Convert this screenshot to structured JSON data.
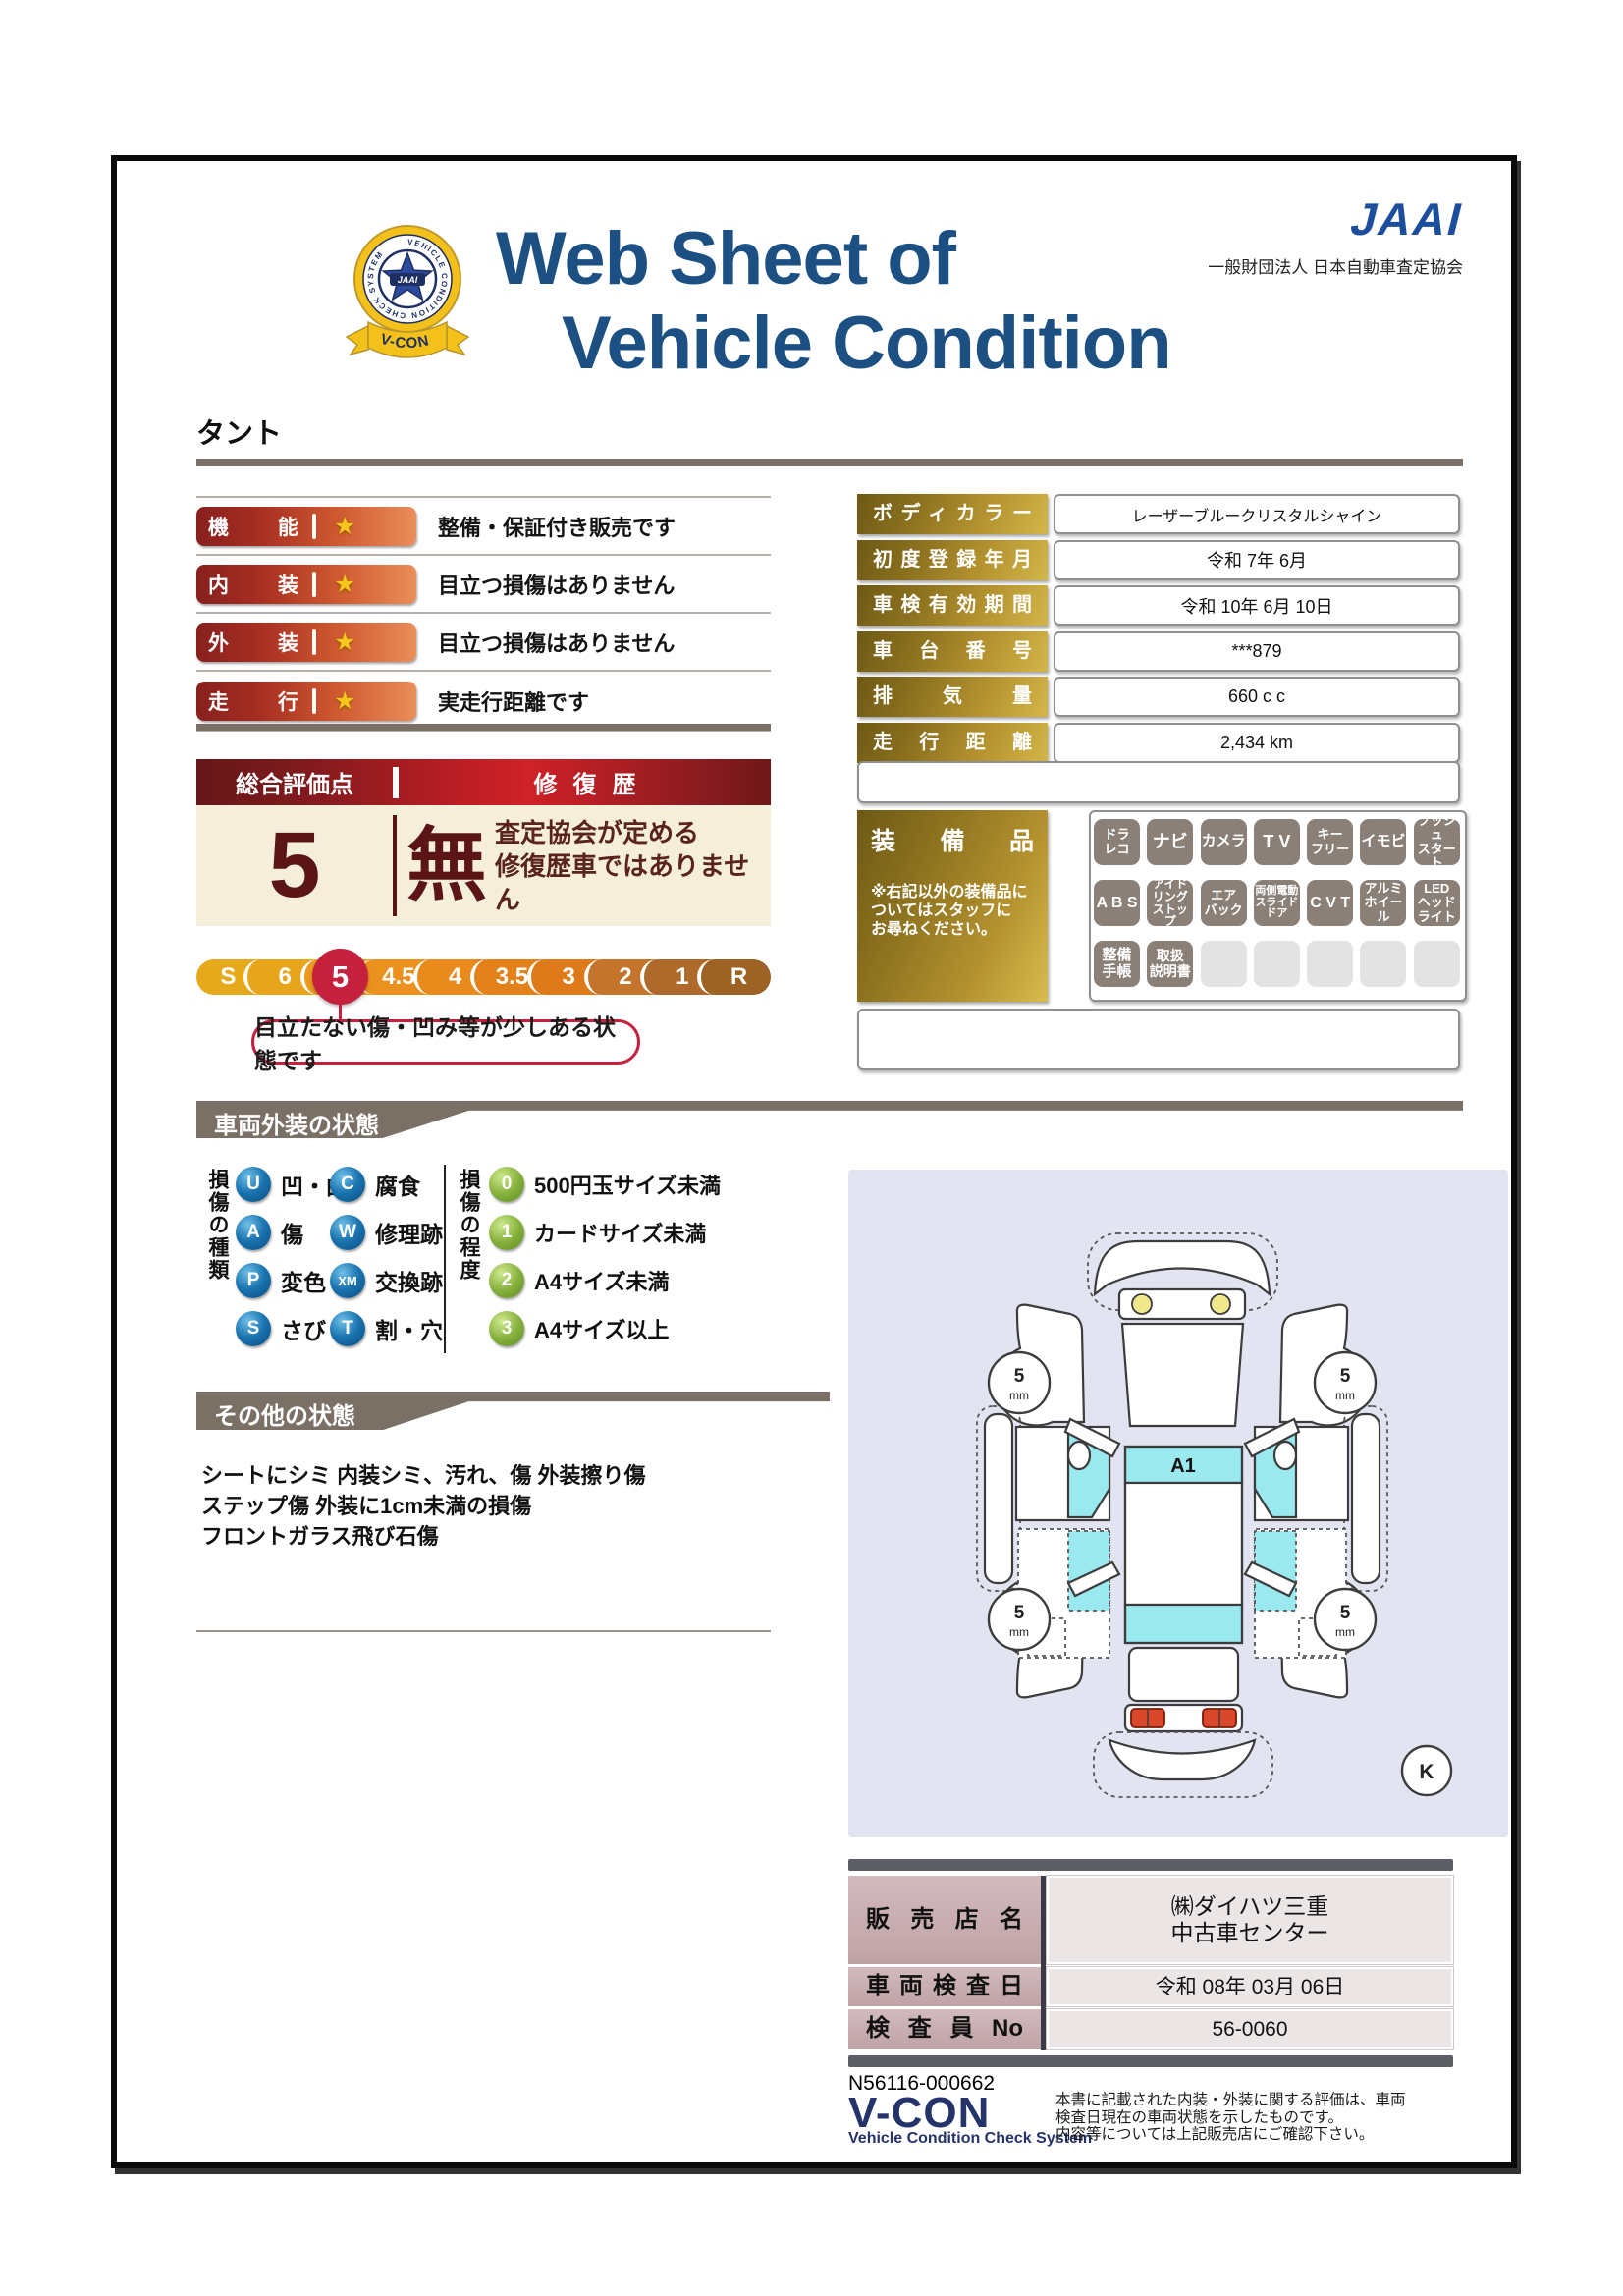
{
  "colors": {
    "accent_red": "#c6203f",
    "maroon": "#5c1517",
    "gold": "#b4922f",
    "navy_title": "#1c5083",
    "jaai_blue": "#1b4f9e",
    "banner_gray": "#7b7065",
    "equip_badge": "#8b8078",
    "legend_blue": "#1a74b0",
    "legend_green": "#86b13c",
    "diagram_bg": "#e2e4f1",
    "diagram_cyan": "#9ae9ee"
  },
  "header": {
    "title_line1": "Web Sheet of",
    "title_line2": "Vehicle Condition",
    "badge": {
      "center": "JAAI",
      "ring": "VEHICLE CONDITION CHECK SYSTEM",
      "ribbon": "V-CON"
    },
    "jaai_wordmark": "JAAI",
    "jaai_org": "一般財団法人 日本自動車査定協会"
  },
  "vehicle_name": "タント",
  "ratings": [
    {
      "label": "機能",
      "star": "★",
      "description": "整備・保証付き販売です"
    },
    {
      "label": "内装",
      "star": "★",
      "description": "目立つ損傷はありません"
    },
    {
      "label": "外装",
      "star": "★",
      "description": "目立つ損傷はありません"
    },
    {
      "label": "走行",
      "star": "★",
      "description": "実走行距離です"
    }
  ],
  "details": [
    {
      "label": "ボディカラー",
      "value": "レーザーブルークリスタルシャイン"
    },
    {
      "label": "初度登録年月",
      "value": "令和 7年 6月"
    },
    {
      "label": "車検有効期間",
      "value": "令和 10年 6月 10日"
    },
    {
      "label": "車台番号",
      "value": "***879"
    },
    {
      "label": "排気量",
      "value": "660 c c"
    },
    {
      "label": "走行距離",
      "value": "2,434 km"
    }
  ],
  "evaluation": {
    "score_title": "総合評価点",
    "repair_title": "修復歴",
    "score": "5",
    "repair_value": "無",
    "repair_note1": "査定協会が定める",
    "repair_note2": "修復歴車ではありません",
    "scale": [
      "S",
      "6",
      "5",
      "4.5",
      "4",
      "3.5",
      "3",
      "2",
      "1",
      "R"
    ],
    "active_grade": "5",
    "callout": "目立たない傷・凹み等が少しある状態です"
  },
  "equipment": {
    "title": "装備品",
    "note": "※右記以外の装備品に\nついてはスタッフに\nお尋ねください。",
    "badges": [
      "ドラ\nレコ",
      "ナビ",
      "カメラ",
      "T V",
      "キー\nフリー",
      "イモビ",
      "プッシュ\nスタート",
      "A B S",
      "アイド\nリング\nストップ",
      "エア\nバック",
      "両側電動\nスライド\nドア",
      "C V T",
      "アルミ\nホイール",
      "LED\nヘッド\nライト",
      "整備\n手帳",
      "取扱\n説明書"
    ]
  },
  "exterior": {
    "title": "車両外装の状態",
    "type_title": "損傷の種類",
    "types": [
      {
        "code": "U",
        "label": "凹・曲"
      },
      {
        "code": "A",
        "label": "傷"
      },
      {
        "code": "P",
        "label": "変色"
      },
      {
        "code": "S",
        "label": "さび"
      },
      {
        "code": "C",
        "label": "腐食"
      },
      {
        "code": "W",
        "label": "修理跡"
      },
      {
        "code": "XM",
        "label": "交換跡"
      },
      {
        "code": "T",
        "label": "割・穴"
      }
    ],
    "degree_title": "損傷の程度",
    "degrees": [
      {
        "code": "0",
        "label": "500円玉サイズ未満"
      },
      {
        "code": "1",
        "label": "カードサイズ未満"
      },
      {
        "code": "2",
        "label": "A4サイズ未満"
      },
      {
        "code": "3",
        "label": "A4サイズ以上"
      }
    ]
  },
  "other": {
    "title": "その他の状態",
    "lines": "シートにシミ 内装シミ、汚れ、傷 外装擦り傷\nステップ傷 外装に1cm未満の損傷\nフロントガラス飛び石傷"
  },
  "diagram": {
    "zone_label": "A1",
    "wheel_value": "5",
    "wheel_unit": "mm",
    "corner_label": "K"
  },
  "dealer": [
    {
      "label": "販売店名",
      "value": "㈱ダイハツ三重\n中古車センター"
    },
    {
      "label": "車両検査日",
      "value": "令和 08年 03月 06日"
    },
    {
      "label": "検査員No",
      "value": "56-0060"
    }
  ],
  "footer": {
    "management_no": "N56116-000662",
    "logo": "V-CON",
    "logo_sub": "Vehicle Condition Check System",
    "disclaimer": "本書に記載された内装・外装に関する評価は、車両\n検査日現在の車両状態を示したものです。\n内容等については上記販売店にご確認下さい。"
  }
}
